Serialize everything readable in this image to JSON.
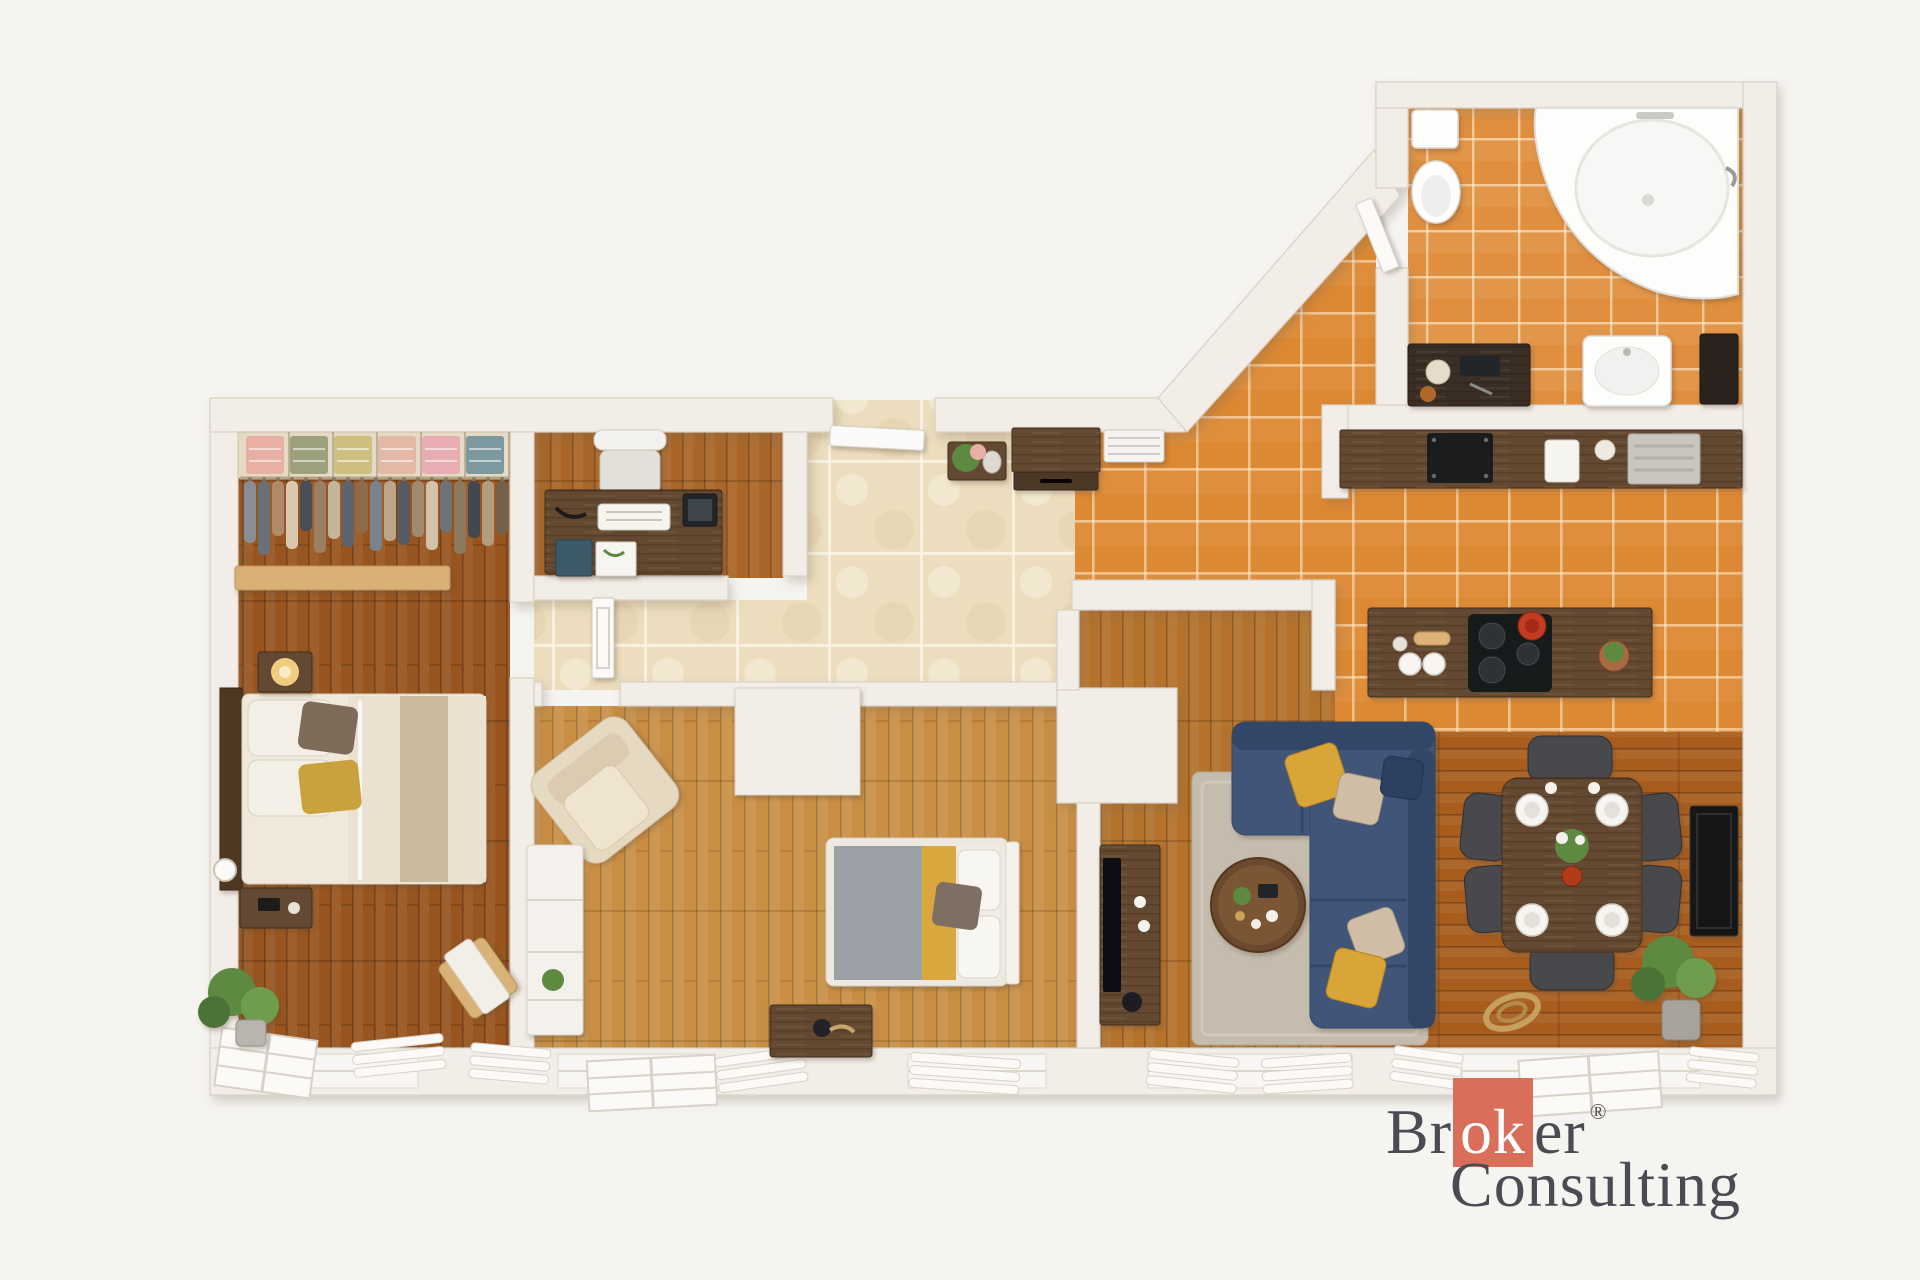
{
  "watermark": {
    "brand_first_segment": "Br",
    "brand_accent_segment": "ok",
    "brand_last_segment": "er",
    "registered_mark": "®",
    "brand_second_line": "Consulting"
  },
  "palette": {
    "bg": "#f6f4f1",
    "wall": "#f2ede6",
    "wall_edge": "#d8d1c5",
    "wood_dark": "#98551f",
    "wood_mid": "#aa6628",
    "wood_light": "#c88e44",
    "wood_living": "#b4722c",
    "wood_dining": "#a85d1e",
    "tile_orange": "#dd8832",
    "tile_bath": "#e08f3e",
    "tile_beige": "#ebddbd",
    "sofa_blue": "#3f5578",
    "sofa_blue_dark": "#314767",
    "rug": "#c5bcae",
    "dark_furniture": "#644931",
    "chair_gray": "#47484d",
    "accent_red": "#db6e5b",
    "logo_text": "#4c4b54",
    "gold": "#d9a437",
    "champagne": "#cfbda6",
    "green": "#5d8a41",
    "cream": "#eae1d0",
    "taupe": "#c9b99f",
    "gray_blanket": "#9ba1a7",
    "yellow_stripe": "#d9a73c"
  },
  "floor_plan": {
    "style": "top-down 3d render",
    "rooms": [
      {
        "name": "walk-in-closet",
        "floor": "dark wood"
      },
      {
        "name": "master-bedroom",
        "floor": "dark wood"
      },
      {
        "name": "home-office",
        "floor": "wood"
      },
      {
        "name": "hallway",
        "floor": "beige stone tile"
      },
      {
        "name": "second-bedroom",
        "floor": "light wood"
      },
      {
        "name": "living-room",
        "floor": "wood"
      },
      {
        "name": "kitchen",
        "floor": "orange tile"
      },
      {
        "name": "dining-area",
        "floor": "wood"
      },
      {
        "name": "bathroom",
        "floor": "orange tile"
      }
    ],
    "closet": {
      "folded_stack_colors": [
        "#e8b0a4",
        "#9aa17c",
        "#cdc07e",
        "#e3b8a6",
        "#e7adb2",
        "#7e98a0"
      ],
      "hanging_garment_colors": [
        "#8a8d93",
        "#6b6f77",
        "#b08968",
        "#d9c7ae",
        "#4a4e57",
        "#9c8063",
        "#c4b49a",
        "#5d646e",
        "#8f6b4a",
        "#7a828c",
        "#bba687",
        "#565b63",
        "#a18a6d",
        "#d3c3a8",
        "#6e7279",
        "#8c7a5e",
        "#43474f",
        "#b49d7f",
        "#75604a"
      ],
      "hanging_garment_heights": [
        62,
        74,
        55,
        68,
        50,
        72,
        58,
        66,
        52,
        70,
        60,
        64,
        56,
        69,
        51,
        73,
        57,
        65,
        53
      ]
    },
    "furniture": {
      "master_bedroom": [
        "double-bed",
        "dark-headboard",
        "nightstand-with-lamp",
        "nightstand",
        "alarm-clock",
        "potted-plant",
        "valet-stool"
      ],
      "walk_in_closet": [
        "shelf-unit",
        "folded-clothes",
        "hanging-clothes",
        "wood-bench-beam"
      ],
      "home_office": [
        "desk",
        "office-chair",
        "keyboard",
        "tablet",
        "notebooks"
      ],
      "hallway": [
        "entry-door",
        "plant-side-table",
        "sideboard",
        "shoe-rack",
        "interior-door-leaf"
      ],
      "second_bedroom": [
        "armchair",
        "white-wardrobe",
        "double-bed",
        "storage-chest",
        "built-in-wardrobe"
      ],
      "living_room": [
        "corner-sofa",
        "throw-pillows",
        "rug",
        "round-coffee-table",
        "tv-stand",
        "tv"
      ],
      "kitchen": [
        "counter-with-sink",
        "island-with-cooktop",
        "red-pot",
        "plates",
        "potted-plant"
      ],
      "dining_area": [
        "dining-table",
        "six-chairs",
        "plates",
        "flower-vase",
        "wall-radiator-panel",
        "potted-plant",
        "rope-coil"
      ],
      "bathroom": [
        "corner-bathtub",
        "toilet",
        "cistern",
        "washbasin",
        "vanity-table",
        "mirror",
        "door-leaf"
      ]
    }
  }
}
